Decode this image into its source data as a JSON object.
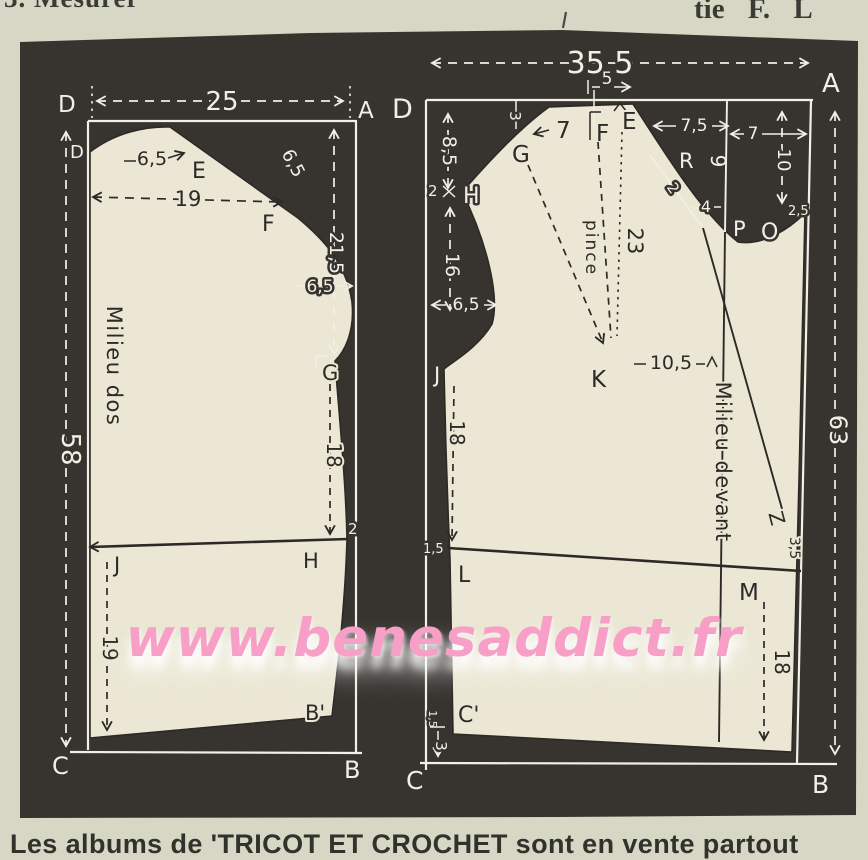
{
  "page": {
    "top_left_text": "3. Mesurer",
    "top_right_text": "tie F. L",
    "bottom_text": "Les albums de 'TRICOT ET CROCHET sont en vente partout",
    "watermark": "www.benesaddict.fr"
  },
  "colors": {
    "paper": "#d6d8c5",
    "panel": "#373430",
    "fabric": "#ebe7d4",
    "ink_light": "#f2efe5",
    "ink_dark": "#2c2926",
    "watermark_pink": "#f79fc6"
  },
  "back_piece": {
    "name": "Milieu dos",
    "points": {
      "D_outer": "D",
      "A": "A",
      "D_inner": "D",
      "E": "E",
      "F": "F",
      "G": "G",
      "H": "H",
      "J": "J",
      "B_inner": "B'",
      "B": "B",
      "C": "C"
    },
    "dims": {
      "width": "25",
      "length": "58",
      "neck_width": "6,5",
      "shoulder_line": "19",
      "shoulder_drop": "6,5",
      "armhole_depth": "21,5",
      "armhole_width": "6,5",
      "underarm_to_waist": "18",
      "waist_offset": "2",
      "waist_to_hem": "19"
    }
  },
  "front_piece": {
    "name": "Milieu devant",
    "dart_label": "pince",
    "points": {
      "D": "D",
      "A": "A",
      "G": "G",
      "F": "F",
      "E": "E",
      "H": "H",
      "J": "J",
      "K": "K",
      "L": "L",
      "M": "M",
      "R": "R",
      "P": "P",
      "O": "O",
      "Z": "Z",
      "C_inner": "C'",
      "C": "C",
      "B": "B"
    },
    "dims": {
      "width": "35,5",
      "length": "63",
      "top_notch": "5",
      "neck_depth": "8,5",
      "shoulder_notch": "3",
      "g_to_f": "7",
      "e_to_r": "7,5",
      "r_depth": "9",
      "band_width": "7",
      "band_depth": "10",
      "diag_2": "2",
      "diag_4": "4",
      "band_2_5": "2,5",
      "side_2": "2",
      "armhole": "16",
      "armhole_width": "6,5",
      "dart_length": "23",
      "dart_to_center": "10,5",
      "j_to_waist": "18",
      "waist_1_5": "1,5",
      "z_offset": "3,5",
      "waist_to_hem": "18",
      "hem_1_5": "1,5",
      "hem_3": "3"
    }
  }
}
